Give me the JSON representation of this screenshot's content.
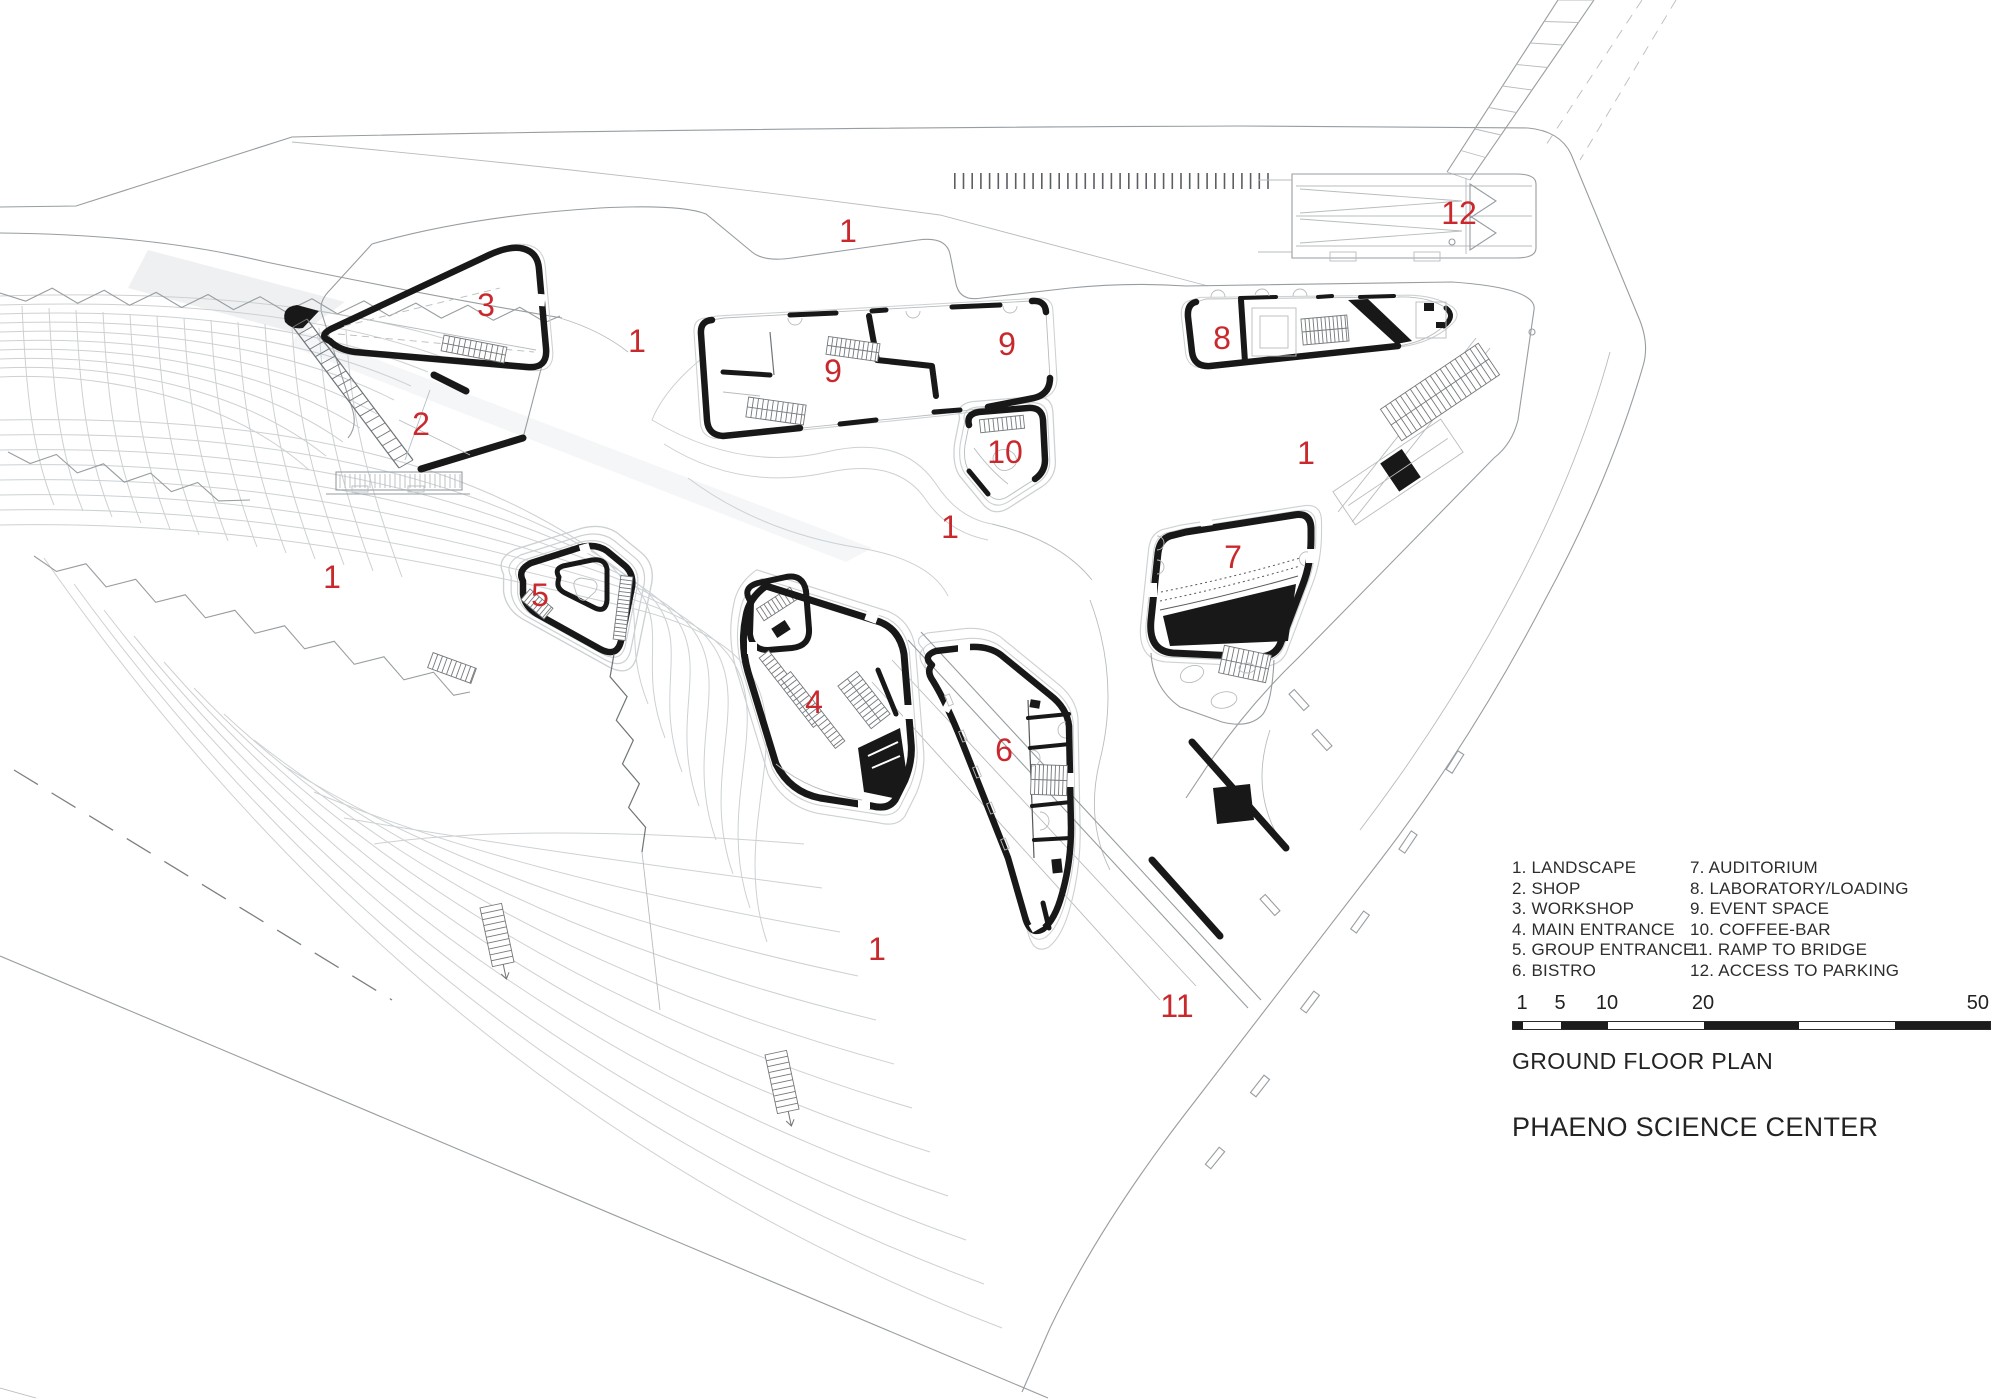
{
  "drawing": {
    "title": "GROUND FLOOR PLAN",
    "project": "PHAENO SCIENCE CENTER"
  },
  "legend": {
    "column1": [
      "1. LANDSCAPE",
      "2. SHOP",
      "3. WORKSHOP",
      "4. MAIN ENTRANCE",
      "5. GROUP ENTRANCE",
      "6. BISTRO"
    ],
    "column2": [
      "7. AUDITORIUM",
      "8. LABORATORY/LOADING",
      "9. EVENT SPACE",
      "10. COFFEE-BAR",
      "11. RAMP TO BRIDGE",
      "12. ACCESS TO PARKING"
    ]
  },
  "scale_bar": {
    "labels": [
      {
        "text": "1",
        "x": 10
      },
      {
        "text": "5",
        "x": 48
      },
      {
        "text": "10",
        "x": 95
      },
      {
        "text": "20",
        "x": 191
      },
      {
        "text": "50",
        "x": 477
      }
    ],
    "segments_meters": [
      [
        0,
        1,
        "black"
      ],
      [
        1,
        5,
        "white"
      ],
      [
        5,
        10,
        "black"
      ],
      [
        10,
        20,
        "white"
      ],
      [
        20,
        30,
        "black"
      ],
      [
        30,
        40,
        "white"
      ],
      [
        40,
        50,
        "black"
      ]
    ],
    "total_meters": 50
  },
  "plan_labels": [
    {
      "text": "1",
      "x": 848,
      "y": 231
    },
    {
      "text": "12",
      "x": 1459,
      "y": 213
    },
    {
      "text": "3",
      "x": 486,
      "y": 305
    },
    {
      "text": "1",
      "x": 637,
      "y": 341
    },
    {
      "text": "9",
      "x": 833,
      "y": 371
    },
    {
      "text": "9",
      "x": 1007,
      "y": 344
    },
    {
      "text": "8",
      "x": 1222,
      "y": 338
    },
    {
      "text": "2",
      "x": 421,
      "y": 424
    },
    {
      "text": "10",
      "x": 1005,
      "y": 452
    },
    {
      "text": "1",
      "x": 1306,
      "y": 453
    },
    {
      "text": "1",
      "x": 950,
      "y": 527
    },
    {
      "text": "7",
      "x": 1233,
      "y": 557
    },
    {
      "text": "1",
      "x": 332,
      "y": 577
    },
    {
      "text": "5",
      "x": 540,
      "y": 595
    },
    {
      "text": "4",
      "x": 814,
      "y": 702
    },
    {
      "text": "6",
      "x": 1004,
      "y": 750
    },
    {
      "text": "1",
      "x": 877,
      "y": 949
    },
    {
      "text": "11",
      "x": 1177,
      "y": 1006
    }
  ],
  "colors": {
    "label_red": "#c9282d",
    "line_black": "#181818",
    "line_gray": "#979da1",
    "line_lightgray": "#ccd1d4"
  }
}
